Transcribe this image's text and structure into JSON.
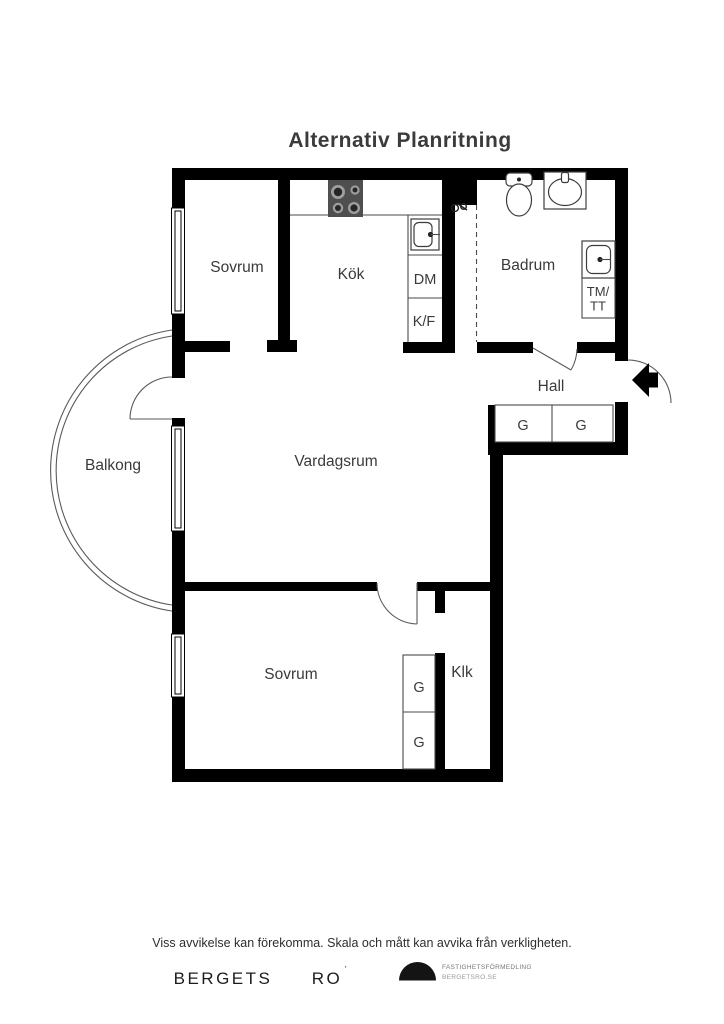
{
  "title": "Alternativ Planritning",
  "rooms": {
    "sovrum_top": "Sovrum",
    "kok": "Kök",
    "badrum": "Badrum",
    "hall": "Hall",
    "balkong": "Balkong",
    "vardagsrum": "Vardagsrum",
    "sovrum_bottom": "Sovrum",
    "klk": "Klk"
  },
  "labels": {
    "dm": "DM",
    "kf": "K/F",
    "tm_line1": "TM/",
    "tm_line2": "TT",
    "wardrobe": "G"
  },
  "icons": {
    "stove": "stove-icon",
    "kitchen_sink": "sink-icon",
    "toilet": "toilet-icon",
    "washbasin": "washbasin-icon",
    "shower_mixer": "shower-mixer-icon",
    "washer": "washer-icon",
    "entrance_arrow": "entrance-arrow-icon",
    "brand_dome": "half-dome-logo"
  },
  "colors": {
    "wall": "#000000",
    "fixture_line": "#4a4a4a",
    "text": "#3a3a3a",
    "logo": "#141414"
  },
  "footer": {
    "disclaimer": "Viss avvikelse kan förekomma. Skala och mått kan avvika från verkligheten.",
    "brand_left": "BERGETS",
    "brand_right": "RO",
    "brand_mark": "'",
    "logo_line1": "FASTIGHETSFÖRMEDLING",
    "logo_line2": "BERGETSRO.SE"
  }
}
